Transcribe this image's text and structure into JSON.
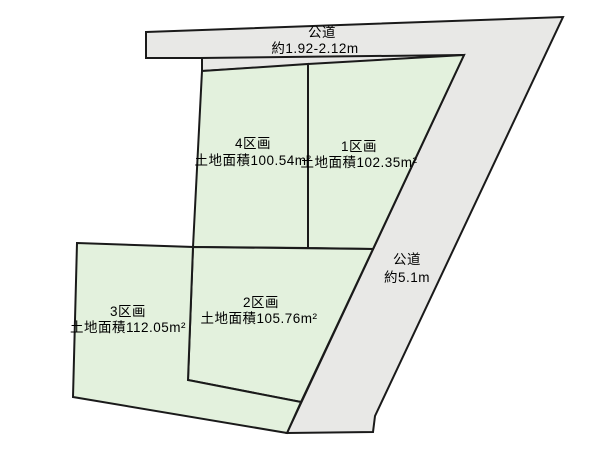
{
  "diagram": {
    "title": "land-parcel-layout",
    "colors": {
      "road_fill": "#e8e8e6",
      "plot_fill": "#e3f1dd",
      "line": "#1a1a1a",
      "background": "#ffffff"
    },
    "road_top": {
      "name": "公道",
      "width_label": "約1.92-2.12m"
    },
    "road_right": {
      "name": "公道",
      "width_label": "約5.1m"
    },
    "plots": [
      {
        "name": "1区画",
        "area_label": "土地面積102.35m²"
      },
      {
        "name": "2区画",
        "area_label": "土地面積105.76m²"
      },
      {
        "name": "3区画",
        "area_label": "土地面積112.05m²"
      },
      {
        "name": "4区画",
        "area_label": "土地面積100.54m²"
      }
    ]
  }
}
